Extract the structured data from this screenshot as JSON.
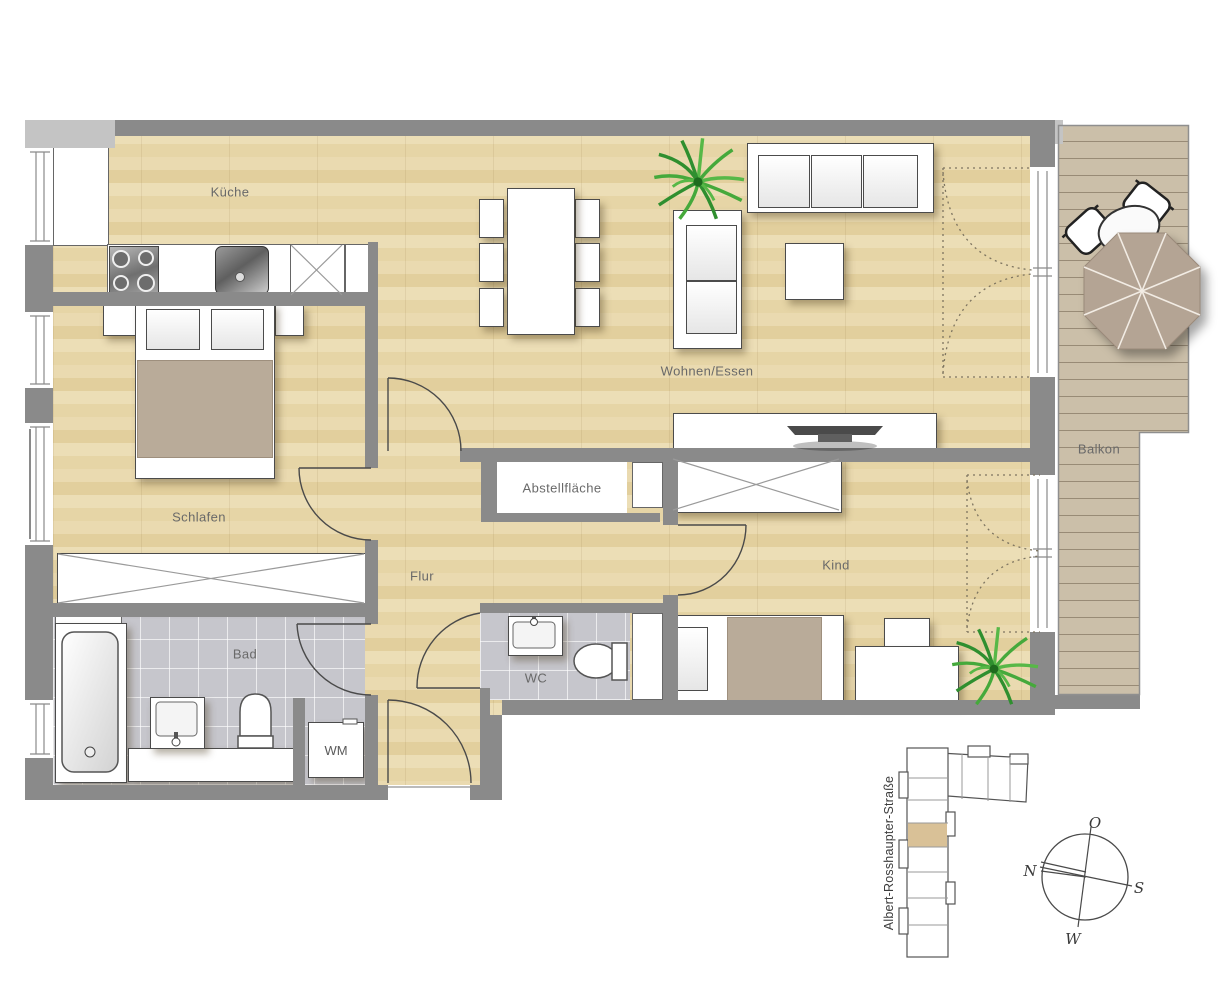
{
  "labels": {
    "kitchen": "Küche",
    "living": "Wohnen/Essen",
    "bedroom": "Schlafen",
    "hall": "Flur",
    "storage": "Abstellfläche",
    "child": "Kind",
    "bath": "Bad",
    "wc": "WC",
    "washer": "WM",
    "balcony": "Balkon"
  },
  "site": {
    "street": "Albert-Rosshaupter-Straße"
  },
  "compass": {
    "top": "O",
    "left": "N",
    "right": "S",
    "bottom": "W"
  },
  "colors": {
    "wall": "#8a8a8a",
    "wall_light": "#c4c4c4",
    "wood_floor": "#e7d6aa",
    "tile_floor": "#c6c6cc",
    "balcony_deck": "#cbbfa9",
    "umbrella": "#b4a494",
    "duvet_accent": "#b9ab99",
    "plant_green": "#3fa33f",
    "highlighted_unit": "#d9c197"
  }
}
